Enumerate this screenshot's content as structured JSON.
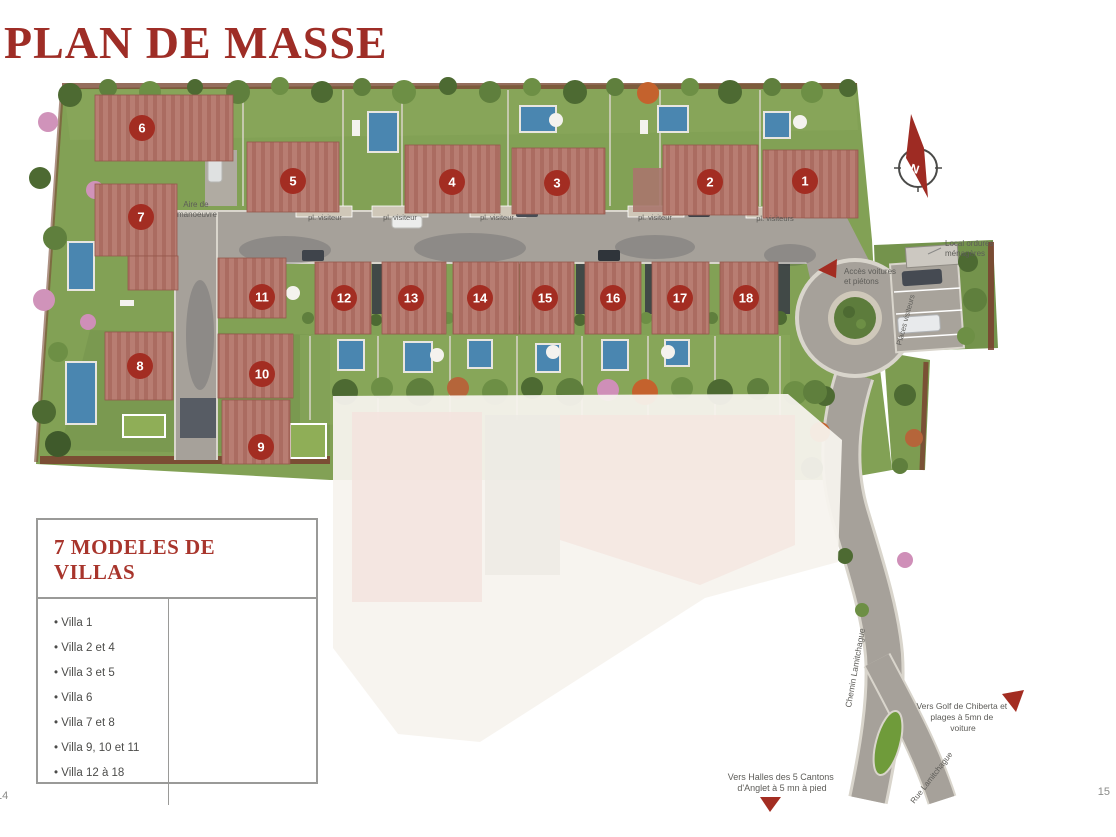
{
  "page": {
    "title": "PLAN DE MASSE",
    "page_number_left": "14",
    "page_number_right": "15"
  },
  "legend": {
    "title": "7 MODELES DE VILLAS",
    "items": [
      "Villa 1",
      "Villa 2 et 4",
      "Villa 3 et 5",
      "Villa 6",
      "Villa 7 et 8",
      "Villa 9, 10 et 11",
      "Villa 12 à 18"
    ]
  },
  "map": {
    "villas": [
      "1",
      "2",
      "3",
      "4",
      "5",
      "6",
      "7",
      "8",
      "9",
      "10",
      "11",
      "12",
      "13",
      "14",
      "15",
      "16",
      "17",
      "18"
    ],
    "labels": {
      "aire": [
        "Aire de",
        "manoeuvre"
      ],
      "pl_visiteur": "pl. visiteur",
      "pl_visiteurs": "pl. visiteurs",
      "acces": [
        "Accès voitures",
        "et piétons"
      ],
      "ordures": [
        "Local ordures",
        "ménagères"
      ],
      "places_visiteurs": "Places visiteurs",
      "chemin": "Chemin Lamitchague",
      "rue": "Rue Lamitchague",
      "golf": [
        "Vers Golf de Chiberta et",
        "plages à 5mn de",
        "voiture"
      ],
      "halles": [
        "Vers Halles des 5 Cantons",
        "d'Anglet à 5 mn à pied"
      ],
      "north": "N"
    },
    "colors": {
      "accent_red": "#9e2d26",
      "badge_red": "#a32d22",
      "roof": "#b87d72",
      "grass": "#82a155",
      "road": "#a6a19a",
      "pool": "#4a86b0"
    }
  }
}
